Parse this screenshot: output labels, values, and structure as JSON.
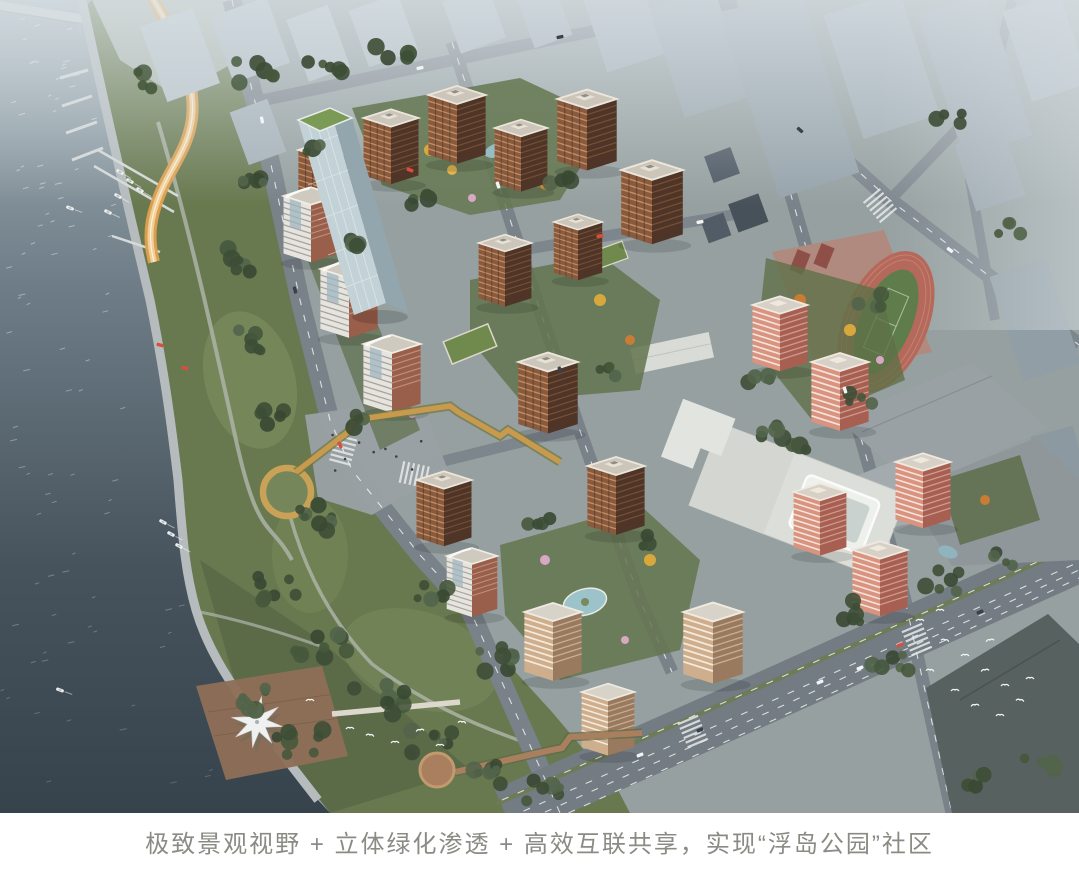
{
  "figure": {
    "kind": "aerial-architectural-rendering",
    "caption": "极致景观视野 + 立体绿化渗透 + 高效互联共享，实现“浮岛公园”社区",
    "scene_elements": [
      "river-water",
      "bridge",
      "marina-piers",
      "boats",
      "waterfront-park",
      "orange-ribbon-path",
      "circular-ring-walk",
      "elevated-golden-walkway",
      "star-canopy-pier",
      "residential-towers",
      "glass-office-tower",
      "commercial-building",
      "school-running-track",
      "school-buildings",
      "city-context-buildings",
      "road-network",
      "courtyard-gardens",
      "birds-flock"
    ],
    "palette": {
      "water_dark": "#37434c",
      "water_light": "#a9b6bc",
      "park_green": "#68794f",
      "tree_green": "#41523a",
      "tower_terracotta": "#8a5a3e",
      "tower_salmon": "#d9937f",
      "track_red": "#b4695b",
      "field_green": "#5f7d4a",
      "context_grey": "#9aa6ae",
      "road_grey": "#798189",
      "walkway_gold": "#c79a4e",
      "caption_text": "#8b8b85"
    }
  }
}
